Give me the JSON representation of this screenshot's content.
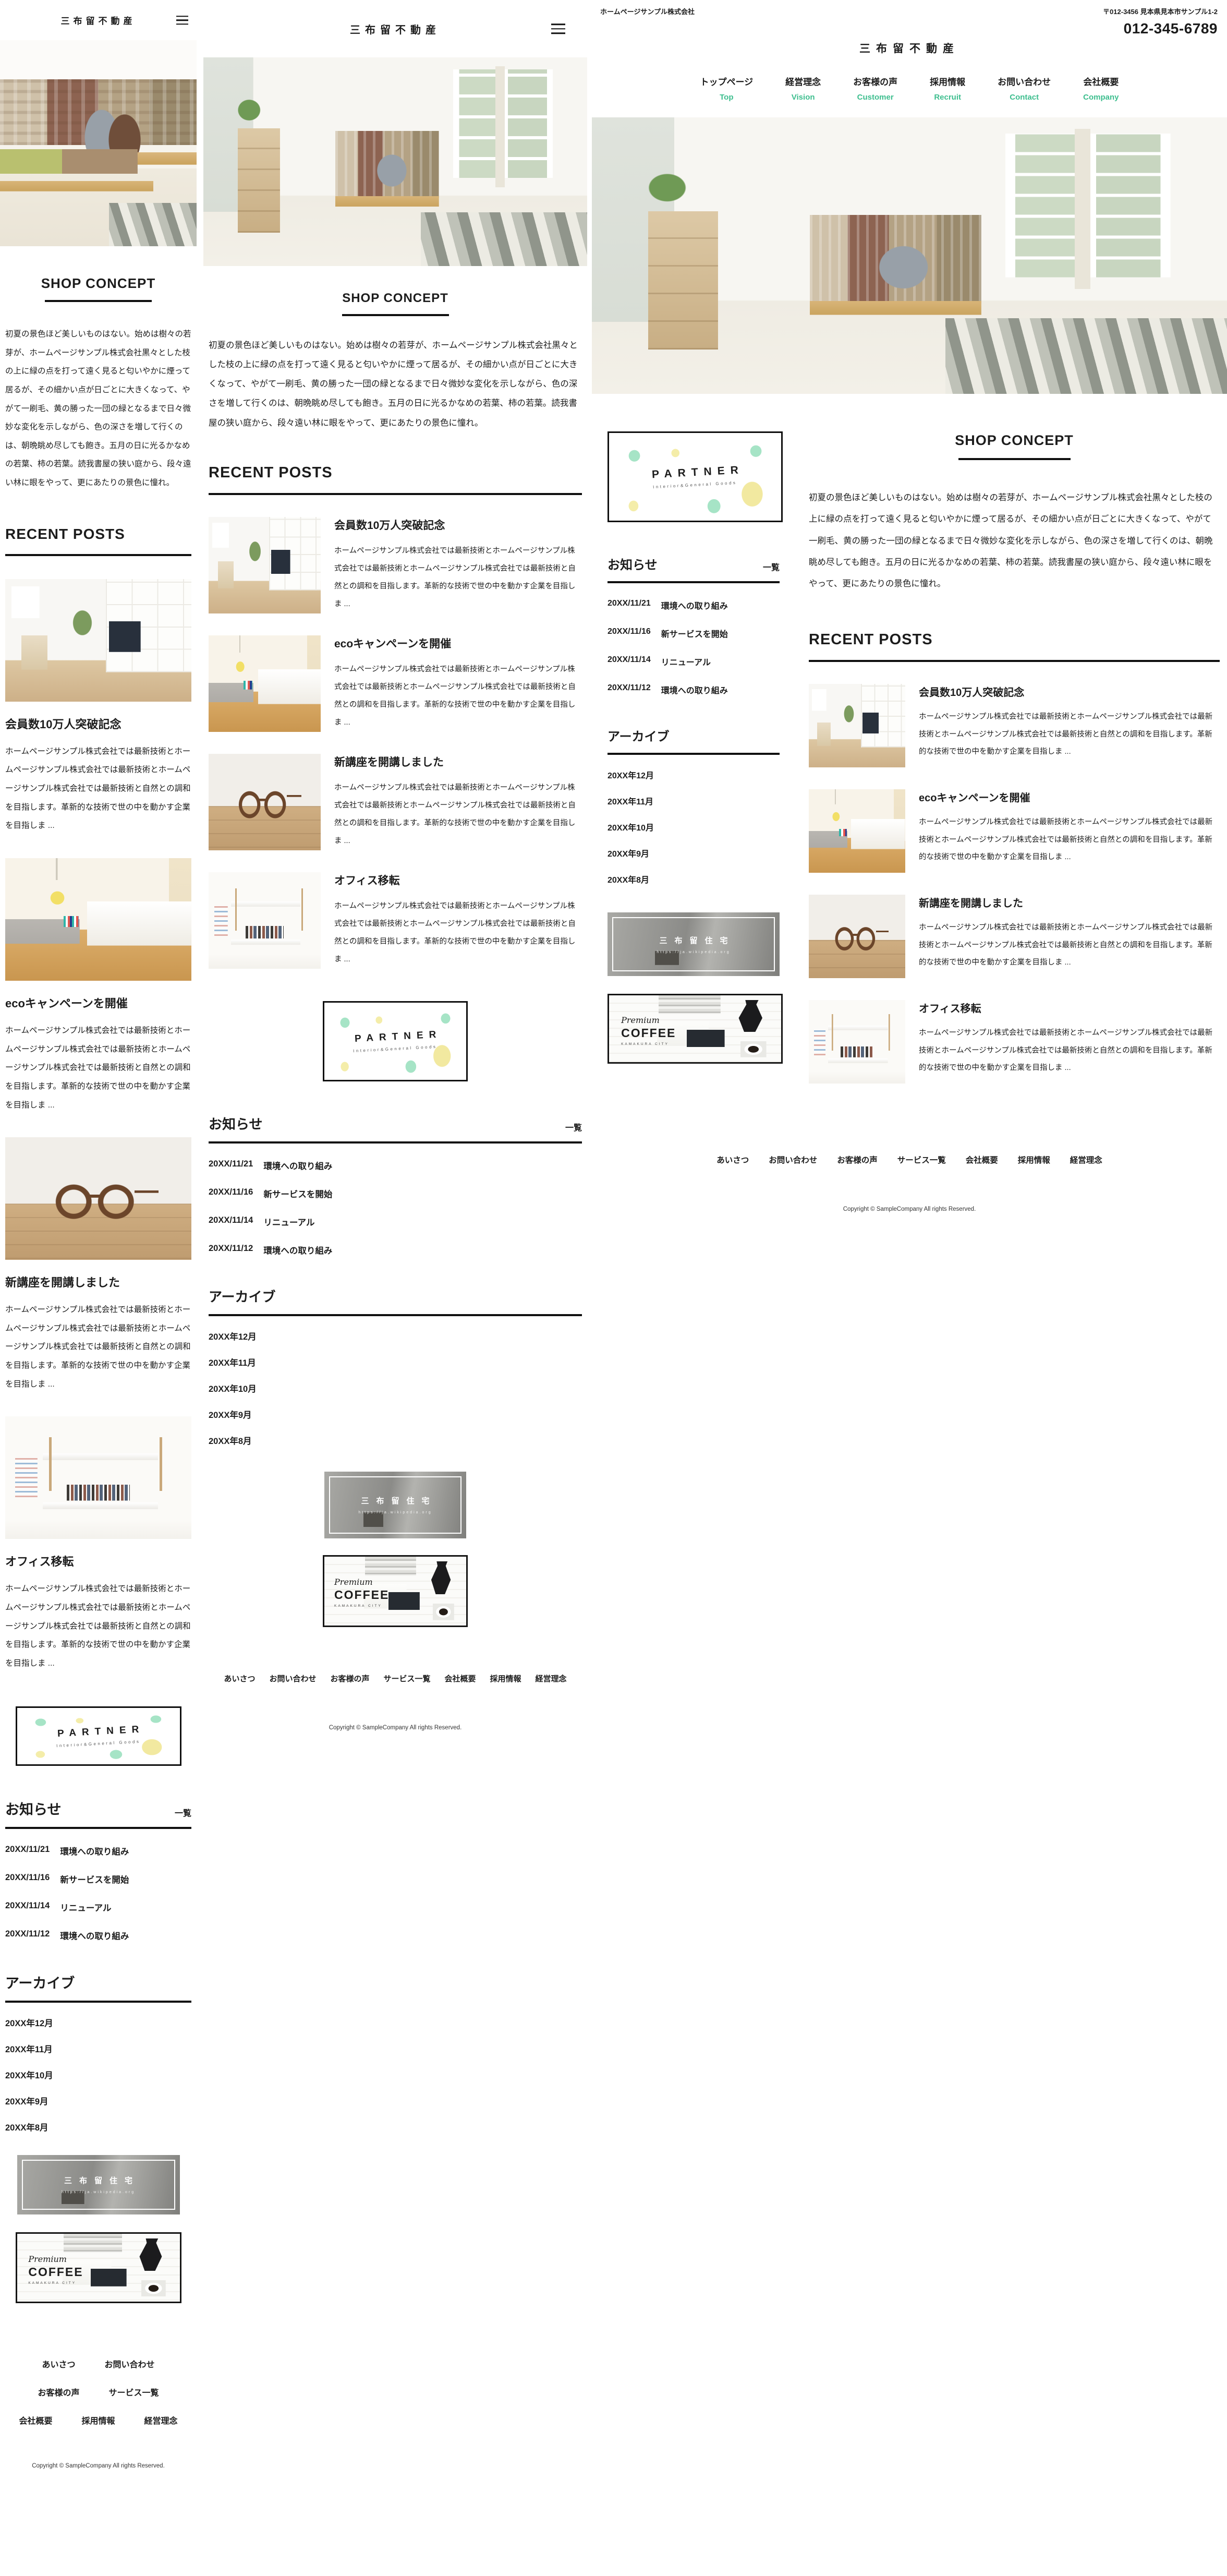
{
  "brand": {
    "logo": "三布留不動産",
    "accent_green": "#3dbe8e"
  },
  "desktop_header": {
    "company_name": "ホームページサンプル株式会社",
    "address": "〒012-3456 見本県見本市サンプル1-2",
    "phone": "012-345-6789",
    "nav": [
      {
        "jp": "トップページ",
        "en": "Top"
      },
      {
        "jp": "経営理念",
        "en": "Vision"
      },
      {
        "jp": "お客様の声",
        "en": "Customer"
      },
      {
        "jp": "採用情報",
        "en": "Recruit"
      },
      {
        "jp": "お問い合わせ",
        "en": "Contact"
      },
      {
        "jp": "会社概要",
        "en": "Company"
      }
    ]
  },
  "shop_concept": {
    "title": "SHOP CONCEPT",
    "body": "初夏の景色ほど美しいものはない。始めは樹々の若芽が、ホームページサンプル株式会社黒々とした枝の上に緑の点を打って遠く見ると匂いやかに煙って居るが、その細かい点が日ごとに大きくなって、やがて一刷毛、黄の勝った一団の緑となるまで日々微妙な変化を示しながら、色の深さを増して行くのは、朝晩眺め尽しても飽き。五月の日に光るかなめの若葉、柿の若葉。読我書屋の狭い庭から、段々遠い林に眼をやって、更にあたりの景色に憧れ。"
  },
  "recent_posts": {
    "title": "RECENT POSTS"
  },
  "posts": [
    {
      "title": "会員数10万人突破記念",
      "excerpt": "ホームページサンプル株式会社では最新技術とホームページサンプル株式会社では最新技術とホームページサンプル株式会社では最新技術と自然との調和を目指します。革新的な技術で世の中を動かす企業を目指しま ..."
    },
    {
      "title": "ecoキャンペーンを開催",
      "excerpt": "ホームページサンプル株式会社では最新技術とホームページサンプル株式会社では最新技術とホームページサンプル株式会社では最新技術と自然との調和を目指します。革新的な技術で世の中を動かす企業を目指しま ..."
    },
    {
      "title": "新講座を開講しました",
      "excerpt": "ホームページサンプル株式会社では最新技術とホームページサンプル株式会社では最新技術とホームページサンプル株式会社では最新技術と自然との調和を目指します。革新的な技術で世の中を動かす企業を目指しま ..."
    },
    {
      "title": "オフィス移転",
      "excerpt": "ホームページサンプル株式会社では最新技術とホームページサンプル株式会社では最新技術とホームページサンプル株式会社では最新技術と自然との調和を目指します。革新的な技術で世の中を動かす企業を目指しま ..."
    }
  ],
  "partner_banner": {
    "title": "PARTNER",
    "subtitle": "Interior&General Goods"
  },
  "news": {
    "title": "お知らせ",
    "more_label": "一覧",
    "items": [
      {
        "date": "20XX/11/21",
        "text": "環境への取り組み"
      },
      {
        "date": "20XX/11/16",
        "text": "新サービスを開始"
      },
      {
        "date": "20XX/11/14",
        "text": "リニューアル"
      },
      {
        "date": "20XX/11/12",
        "text": "環境への取り組み"
      }
    ]
  },
  "archive": {
    "title": "アーカイブ",
    "items": [
      "20XX年12月",
      "20XX年11月",
      "20XX年10月",
      "20XX年9月",
      "20XX年8月"
    ]
  },
  "jutaku_banner": {
    "title": "三布留住宅",
    "url": "https://ja.wikipedia.org"
  },
  "coffee_banner": {
    "pre": "Premium",
    "title": "COFFEE",
    "subtitle": "KAMAKURA CITY"
  },
  "footer": {
    "links": [
      "あいさつ",
      "お問い合わせ",
      "お客様の声",
      "サービス一覧",
      "会社概要",
      "採用情報",
      "経営理念"
    ],
    "copyright": "Copyright © SampleCompany All rights Reserved."
  }
}
